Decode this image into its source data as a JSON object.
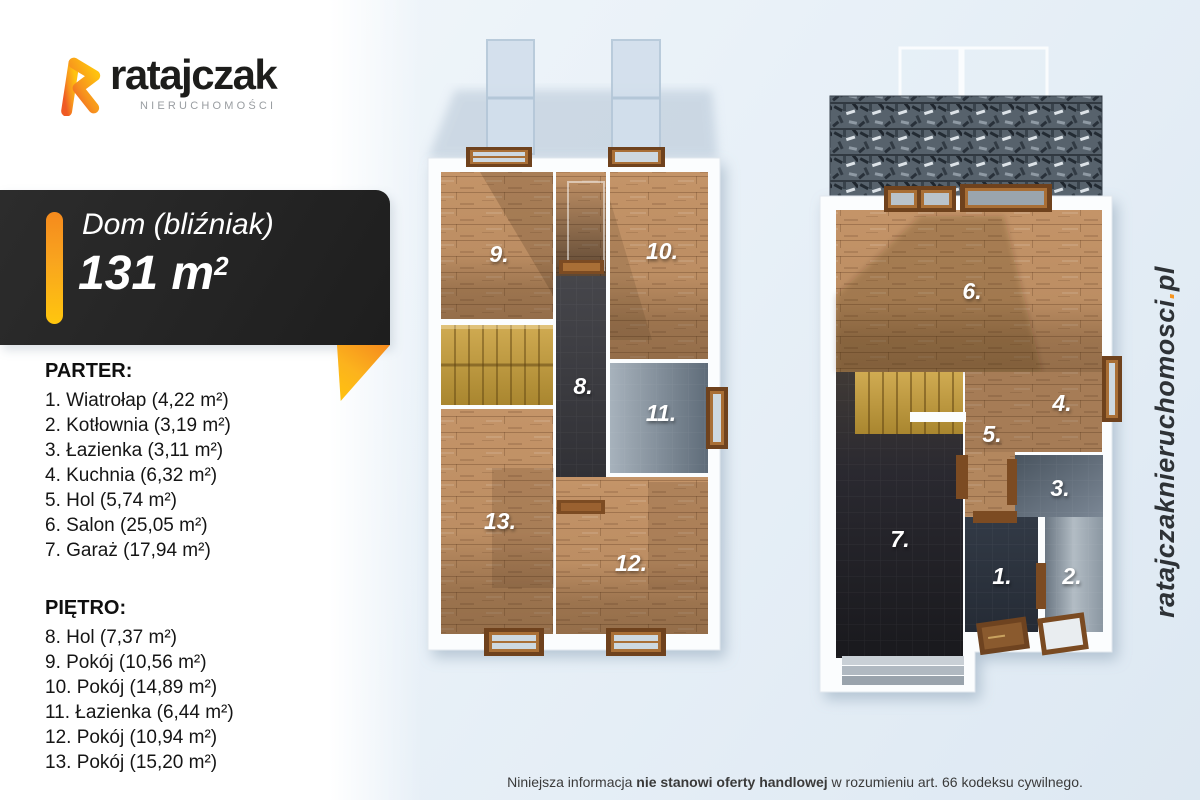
{
  "logo": {
    "brand": "ratajczak",
    "subtitle": "NIERUCHOMOŚCI"
  },
  "title_card": {
    "title": "Dom (bliźniak)",
    "area_value": "131 m",
    "area_sup": "2"
  },
  "ground_floor_list": {
    "heading": "PARTER:",
    "items": [
      "1. Wiatrołap (4,22 m²)",
      "2. Kotłownia (3,19 m²)",
      "3. Łazienka (3,11 m²)",
      "4. Kuchnia (6,32 m²)",
      "5. Hol (5,74 m²)",
      "6. Salon (25,05 m²)",
      "7. Garaż (17,94 m²)"
    ]
  },
  "upper_floor_list": {
    "heading": "PIĘTRO:",
    "items": [
      "8. Hol (7,37 m²)",
      "9. Pokój (10,56 m²)",
      "10. Pokój (14,89 m²)",
      "11. Łazienka (6,44 m²)",
      "12. Pokój (10,94 m²)",
      "13. Pokój (15,20 m²)"
    ]
  },
  "plans": {
    "upper": {
      "labels": [
        "8.",
        "9.",
        "10.",
        "11.",
        "12.",
        "13."
      ]
    },
    "ground": {
      "labels": [
        "1.",
        "2.",
        "3.",
        "4.",
        "5.",
        "6.",
        "7."
      ]
    }
  },
  "website": {
    "name": "ratajczaknieruchomosci",
    "separator": ".",
    "tld": "pl"
  },
  "disclaimer": {
    "prefix": "Niniejsza informacja ",
    "bold": "nie stanowi oferty handlowej",
    "suffix": " w rozumieniu art. 66 kodeksu cywilnego."
  },
  "colors": {
    "accent_orange": "#f7941e",
    "accent_yellow": "#ffc20e",
    "card_black": "#242424",
    "background_blue": "#e9f1f8",
    "wood_floor": "#c49468",
    "dark_floor": "#2a2a2e",
    "tile_gray": "#7d8a96",
    "window_brown": "#6f421d"
  }
}
